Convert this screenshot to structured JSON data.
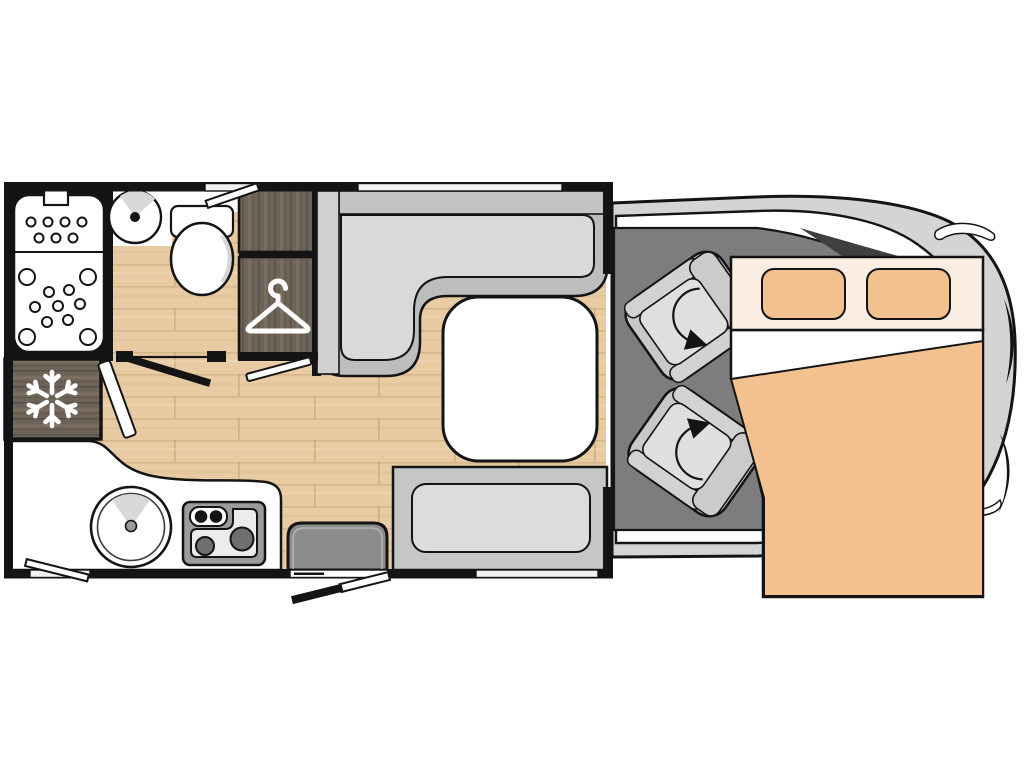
{
  "meta": {
    "diagram_type": "motorhome-floor-plan",
    "view": "top-down",
    "text_labels": []
  },
  "colors": {
    "outline": "#141414",
    "background": "#ffffff",
    "wood_floor": "#e8cba3",
    "dark_wood": "#6f6459",
    "cab_body": "#d4d4d4",
    "cab_floor": "#7d7d7d",
    "pillar_shadow": "#3f3f3f",
    "seat_base": "#c8c8c8",
    "seat_arm": "#d2d2d2",
    "seat_back": "#cbcbcb",
    "seat_cushion": "#dfdfdf",
    "dinette_base": "#bdbdbd",
    "dinette_back": "#c3c3c3",
    "dinette_side": "#d0d0d0",
    "dinette_cushion": "#d9d9d9",
    "bench_base": "#c6c6c6",
    "bench_cushion": "#dcdcdc",
    "table_top": "#ffffff",
    "bed_header": "#faeee2",
    "bed_pillow": "#f2c18f",
    "bed_blanket": "#f2c18f",
    "bed_sheet": "#ffffff",
    "step": "#8c8c8c",
    "stove_frame": "#9c9c9c",
    "stove_panel": "#ececec",
    "burner": "#6f6f6f",
    "counter": "#ffffff",
    "fixture": "#ffffff",
    "shade": "#d8d8d8",
    "window_glass": "#f2f2f2"
  },
  "icons": [
    {
      "name": "snowflake-icon",
      "meaning": "refrigerator / freezer"
    },
    {
      "name": "hanger-icon",
      "meaning": "wardrobe closet"
    },
    {
      "name": "swivel-arrow-icon",
      "meaning": "rotating cab seat"
    },
    {
      "name": "drain-dots-icon",
      "meaning": "shower tray"
    },
    {
      "name": "burner-icon",
      "meaning": "gas hob"
    }
  ],
  "areas": [
    {
      "name": "shower"
    },
    {
      "name": "washbasin"
    },
    {
      "name": "toilet"
    },
    {
      "name": "wardrobe"
    },
    {
      "name": "refrigerator"
    },
    {
      "name": "kitchen-counter"
    },
    {
      "name": "kitchen-sink"
    },
    {
      "name": "stove"
    },
    {
      "name": "dinette-l-seat"
    },
    {
      "name": "dinette-table"
    },
    {
      "name": "bench-seat"
    },
    {
      "name": "entry-step"
    },
    {
      "name": "entry-door"
    },
    {
      "name": "cab-seat-passenger"
    },
    {
      "name": "cab-seat-driver"
    },
    {
      "name": "drop-down-bed"
    },
    {
      "name": "vehicle-cab-front"
    }
  ]
}
